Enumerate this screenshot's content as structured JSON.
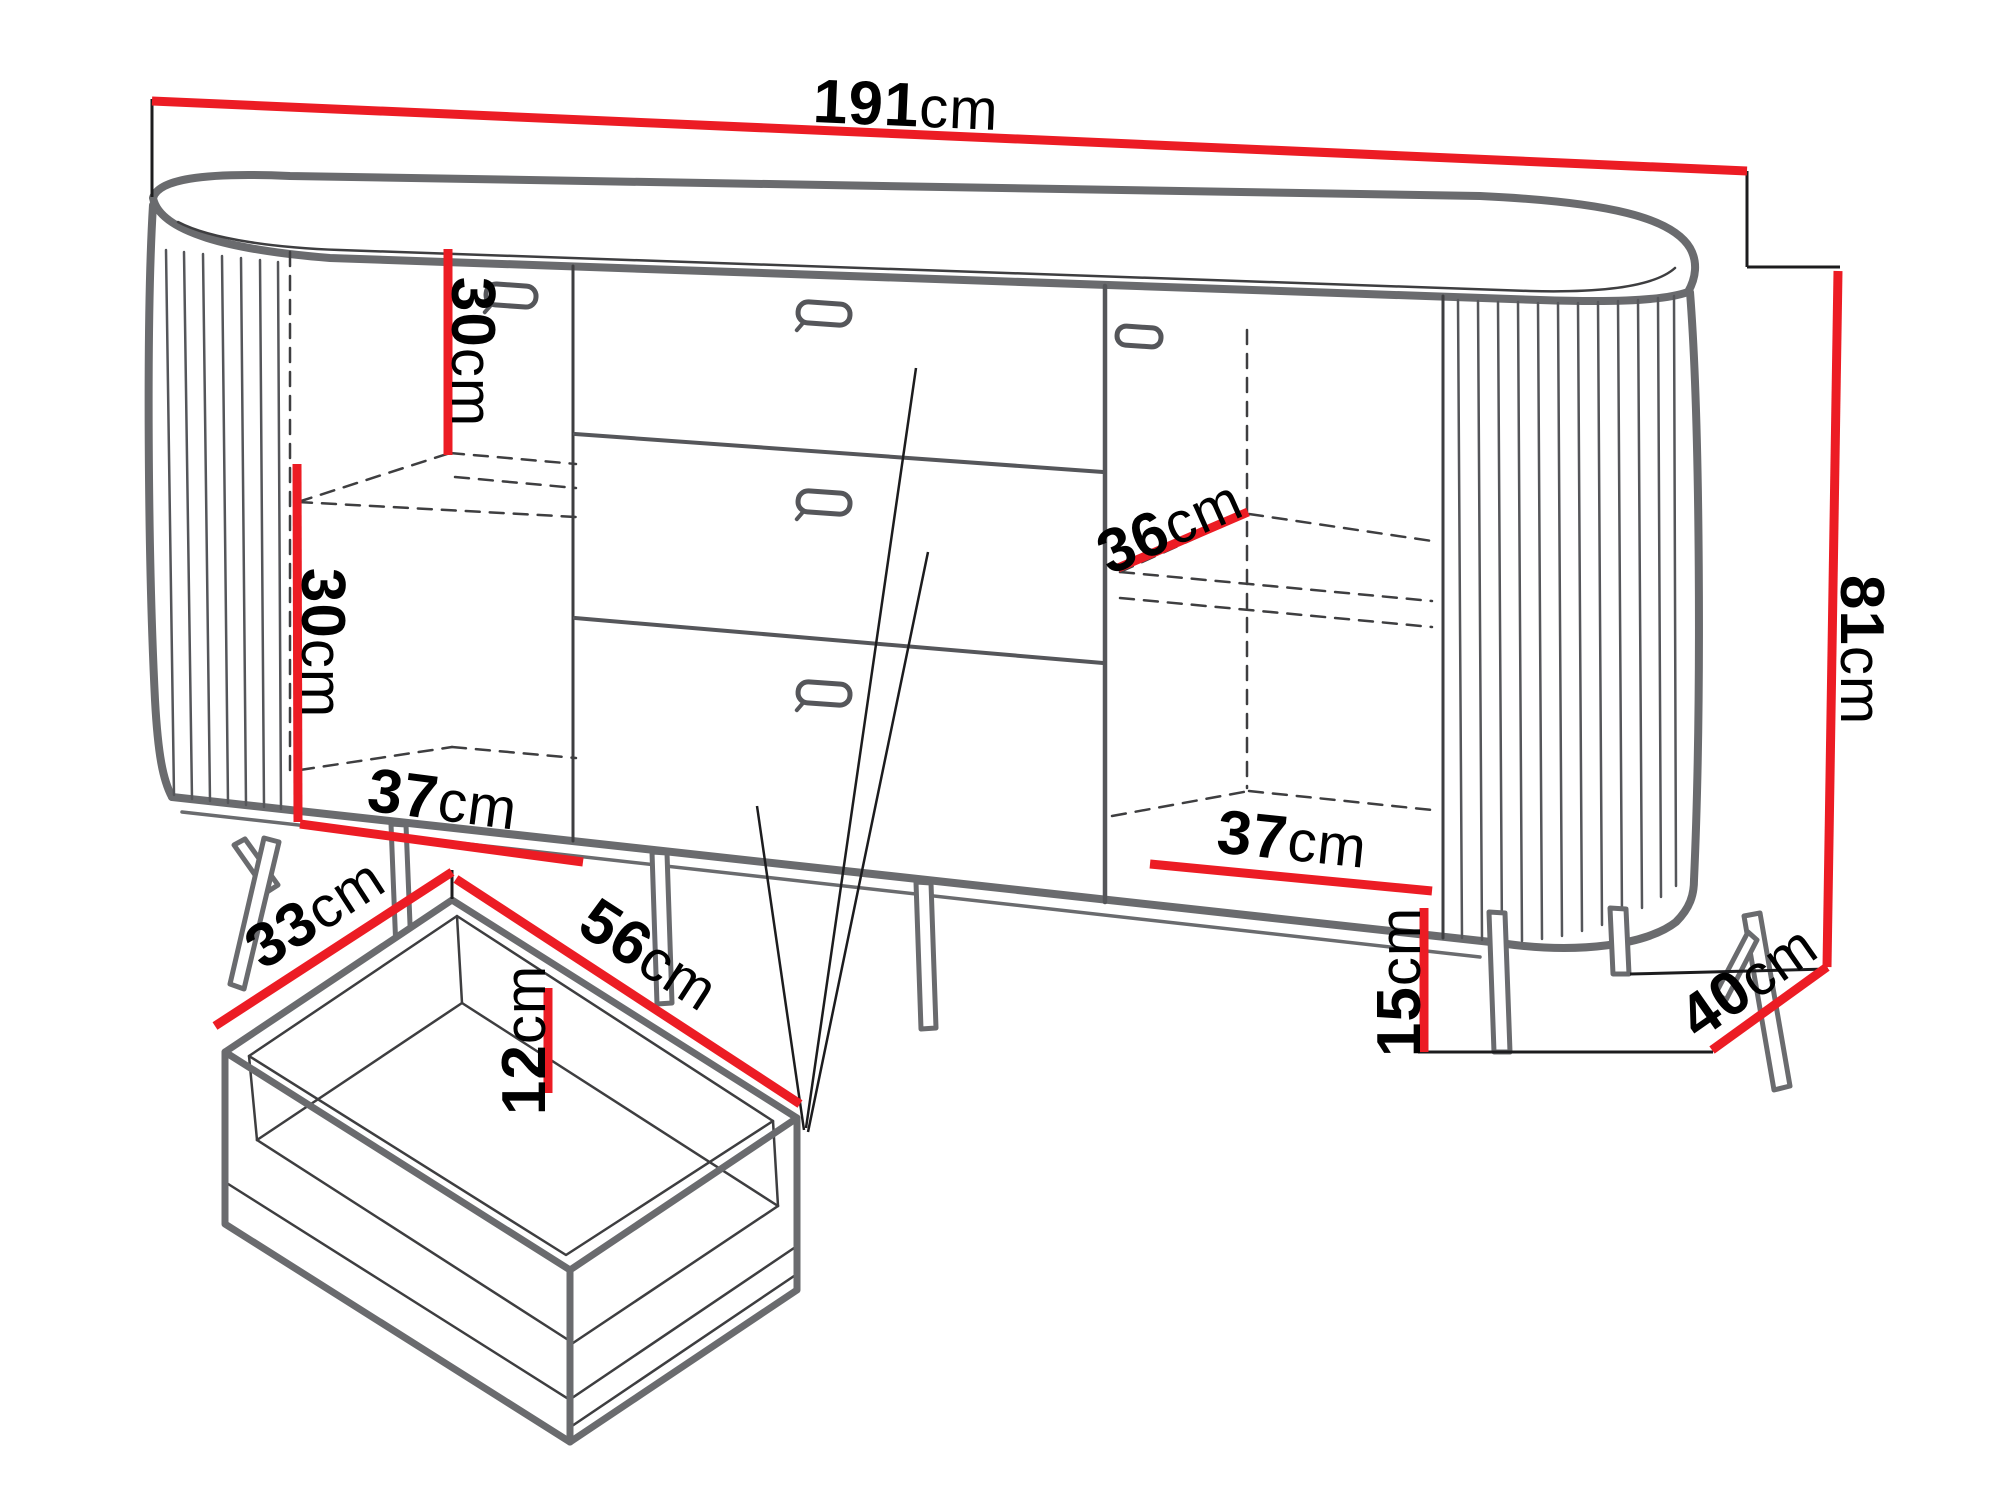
{
  "figure": {
    "type": "furniture-dimension-diagram",
    "subject": "sideboard with two fluted doors, three central drawers and open drawer detail"
  },
  "colors": {
    "dimension_line": "#ec1c24",
    "outline_thick": "#6a6b6e",
    "outline_thin": "#3e3e40",
    "label_text": "#000000",
    "background": "#ffffff"
  },
  "dims": {
    "total_width": {
      "num": "191",
      "unit": "cm"
    },
    "total_height": {
      "num": "81",
      "unit": "cm"
    },
    "upper_shelf_height": {
      "num": "30",
      "unit": "cm"
    },
    "lower_shelf_height": {
      "num": "30",
      "unit": "cm"
    },
    "left_compartment_width": {
      "num": "37",
      "unit": "cm"
    },
    "right_shelf_depth": {
      "num": "36",
      "unit": "cm"
    },
    "right_compartment_width": {
      "num": "37",
      "unit": "cm"
    },
    "leg_height": {
      "num": "15",
      "unit": "cm"
    },
    "total_depth": {
      "num": "40",
      "unit": "cm"
    },
    "drawer_inner_depth": {
      "num": "33",
      "unit": "cm"
    },
    "drawer_inner_width": {
      "num": "56",
      "unit": "cm"
    },
    "drawer_inner_height": {
      "num": "12",
      "unit": "cm"
    }
  }
}
